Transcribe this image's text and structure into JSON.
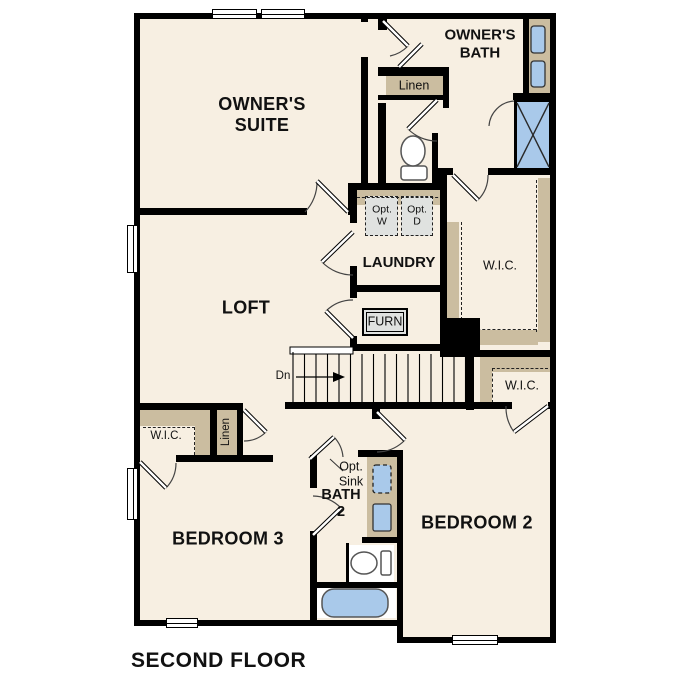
{
  "floor_plan": {
    "title": "SECOND FLOOR",
    "rooms": {
      "owners_suite": "OWNER'S SUITE",
      "owners_bath": "OWNER'S BATH",
      "laundry": "LAUNDRY",
      "loft": "LOFT",
      "bedroom2": "BEDROOM 2",
      "bedroom3": "BEDROOM 3",
      "bath2": "BATH 2",
      "wic_owners": "W.I.C.",
      "wic_bedroom2": "W.I.C.",
      "wic_bedroom3": "W.I.C.",
      "linen_upper": "Linen",
      "linen_hall": "Linen"
    },
    "annotations": {
      "opt_washer": "Opt. W",
      "opt_dryer": "Opt. D",
      "furnace": "FURN",
      "stairs_down": "Dn",
      "opt_sink": "Opt. Sink"
    },
    "colors": {
      "floor": "#f7efe2",
      "wall": "#000000",
      "casework": "#cbbda0",
      "fixture_blue": "#a9c9ea",
      "appliance_gray": "#e0e2e0"
    }
  }
}
